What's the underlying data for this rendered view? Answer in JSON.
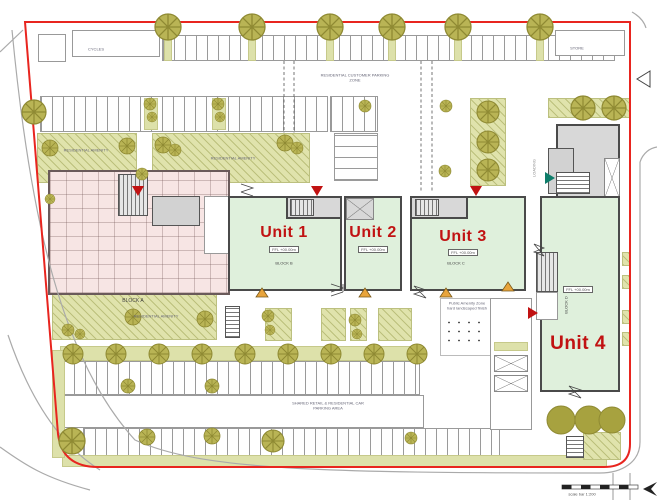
{
  "colors": {
    "boundary": "#e8251f",
    "unit_fill": "#dff0dc",
    "landscape": "#e0e3ac",
    "tree": "#b9b455",
    "residential_fill": "#f7e5e4",
    "label_red": "#c11212",
    "entrance_orange": "#e8a43c"
  },
  "units": {
    "unit1": "Unit 1",
    "unit2": "Unit 2",
    "unit3": "Unit 3",
    "unit4": "Unit 4"
  },
  "blocks": {
    "a": "BLOCK A",
    "b": "BLOCK B",
    "c": "BLOCK C",
    "d": "BLOCK D"
  },
  "areas": {
    "residential_amenity": "RESIDENTIAL AMENITY",
    "public_amenity_1": "Public Amenity Zone",
    "public_amenity_2": "hard landscaped finish",
    "top_parking_1": "RESIDENTIAL CUSTOMER PARKING",
    "top_parking_2": "ZONE",
    "shared_parking_1": "SHARED RETAIL & RESIDENTIAL CAR",
    "shared_parking_2": "PARKING AREA",
    "loading": "LOADING",
    "cycles": "CYCLES",
    "store": "STORE",
    "ffl": "FFL +00.00m",
    "scale": "scale bar 1:200"
  }
}
